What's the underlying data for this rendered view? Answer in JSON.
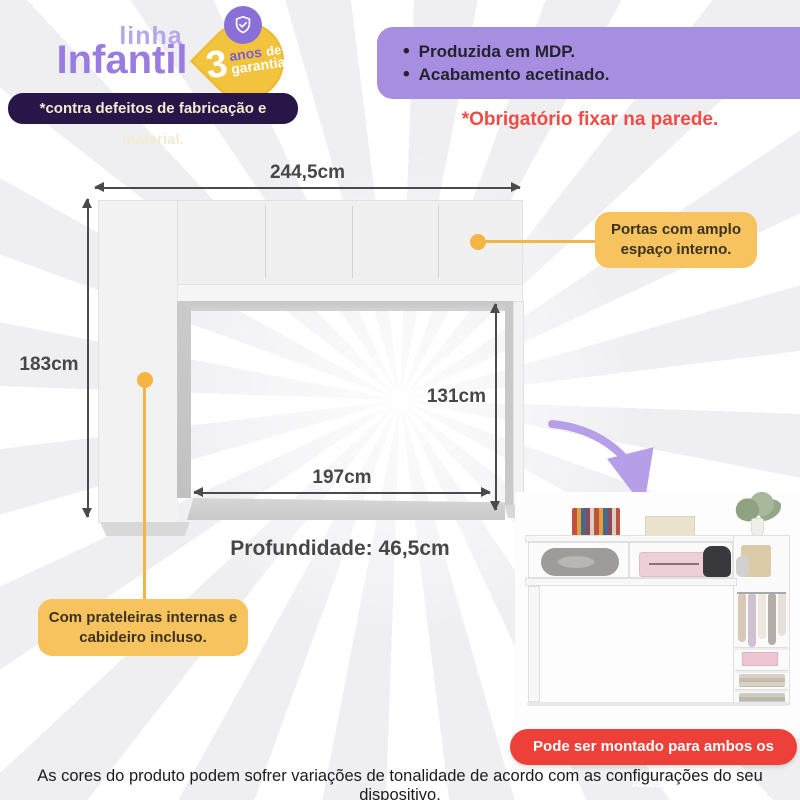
{
  "brand": {
    "line_label": "linha",
    "name": "Infantil"
  },
  "badge": {
    "number": "3",
    "line1_accent": "anos",
    "line1_rest": "de",
    "line2": "garantia",
    "icon": "shield-check-icon"
  },
  "warranty_note": "*contra defeitos de fabricação e material.",
  "features": {
    "bullet": "•",
    "items": [
      {
        "label": "Produzida em MDP."
      },
      {
        "label": "Acabamento acetinado."
      }
    ]
  },
  "wall_warning": "*Obrigatório fixar na parede.",
  "dimensions": {
    "total_width": "244,5cm",
    "total_height": "183cm",
    "inner_height": "131cm",
    "inner_width": "197cm",
    "depth": "Profundidade: 46,5cm"
  },
  "callouts": {
    "doors": "Portas com amplo espaço interno.",
    "shelves": "Com prateleiras internas e cabideiro incluso."
  },
  "assembly_banner": "Pode ser montado para ambos os lados.",
  "disclaimer": "As cores do produto podem sofrer variações de tonalidade de acordo com as configurações do seu dispositivo.",
  "colors": {
    "purple_light": "#b7a7e8",
    "purple_brand": "#9a7ce0",
    "purple_box": "#a78ee0",
    "purple_dark": "#281649",
    "badge_yellow": "#f2c33d",
    "callout_yellow": "#f6c35f",
    "connector_yellow": "#f4b545",
    "warning_red": "#ee4c45",
    "banner_red": "#ec4038",
    "arrow_gray": "#4a4a4a"
  }
}
